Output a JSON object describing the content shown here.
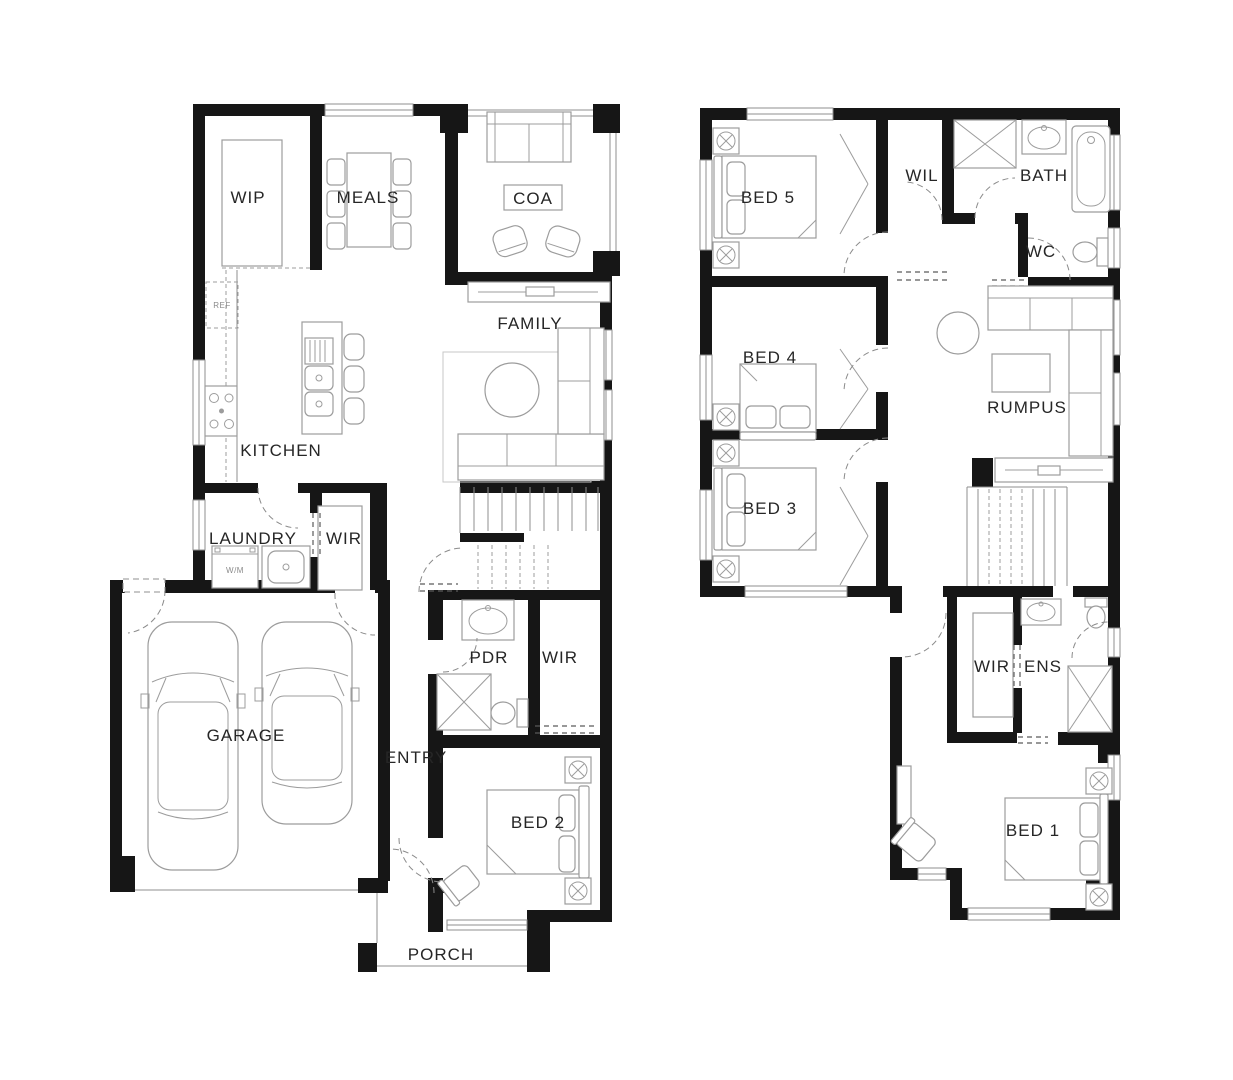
{
  "document": {
    "type": "floorplan",
    "floors": [
      "ground",
      "first"
    ]
  },
  "ground_floor": {
    "wip": "WIP",
    "meals": "MEALS",
    "coa": "COA",
    "family": "FAMILY",
    "kitchen": "KITCHEN",
    "laundry": "LAUNDRY",
    "wir": "WIR",
    "garage": "GARAGE",
    "pdr": "PDR",
    "wir2": "WIR",
    "entry": "ENTRY",
    "bed2": "BED 2",
    "porch": "PORCH",
    "ref": "REF",
    "wm": "W/M"
  },
  "first_floor": {
    "bed5": "BED 5",
    "wil": "WIL",
    "bath": "BATH",
    "wc": "WC",
    "bed4": "BED 4",
    "rumpus": "RUMPUS",
    "bed3": "BED 3",
    "wir": "WIR",
    "ens": "ENS",
    "bed1": "BED 1"
  },
  "colors": {
    "background": "#ffffff",
    "walls": "#161616",
    "furniture": "#9c9c9c",
    "labels": "#262626"
  }
}
